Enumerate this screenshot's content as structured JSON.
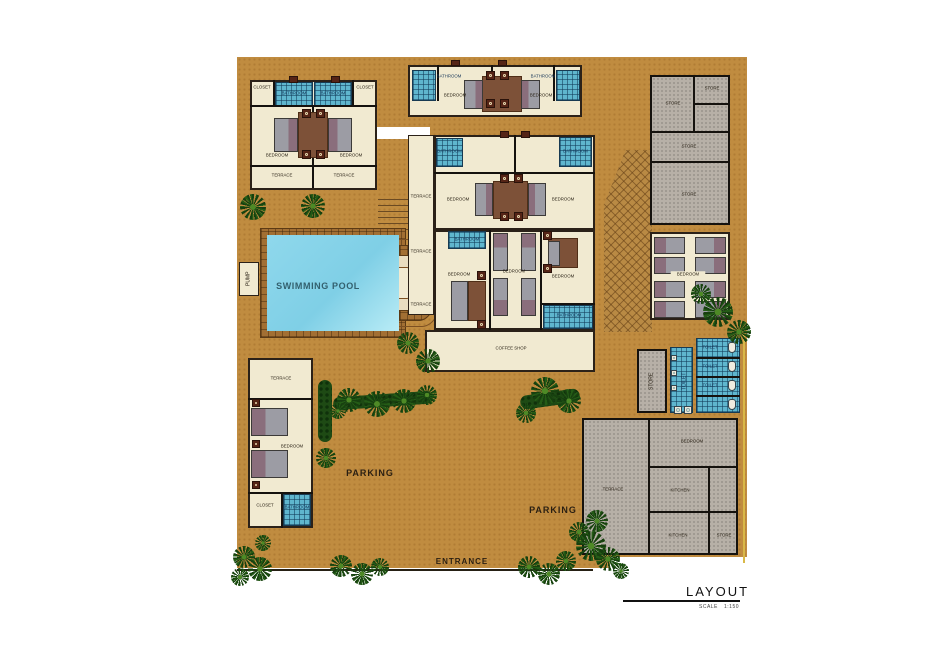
{
  "title_block": {
    "title": "LAYOUT",
    "scale_label": "SCALE",
    "scale_value": "1:150"
  },
  "site": {
    "pool": "SWIMMING POOL",
    "pump": "PUMP",
    "parking_left": "PARKING",
    "parking_right": "PARKING",
    "entrance": "ENTRANCE"
  },
  "villa_top_left": {
    "closet_l": "CLOSET",
    "closet_r": "CLOSET",
    "bath_l": "BATHROOM",
    "bath_r": "BATHROOM",
    "bed_l": "BEDROOM",
    "bed_r": "BEDROOM",
    "terr_l": "TERRACE",
    "terr_r": "TERRACE"
  },
  "villa_top_mid": {
    "bath_l": "BATHROOM",
    "bath_r": "BATHROOM",
    "bed_l": "BEDROOM",
    "bed_r": "BEDROOM"
  },
  "main_building": {
    "terr_1": "TERRACE",
    "terr_2": "TERRACE",
    "terr_3": "TERRACE",
    "bath_tl": "BATHROOM",
    "bath_tr": "BATHROOM",
    "bath_ml": "BATHROOM",
    "bath_br": "BATHROOM",
    "bed_ul": "BEDROOM",
    "bed_ur": "BEDROOM",
    "bed_ll": "BEDROOM",
    "bed_c": "BEDROOM",
    "bed_lr": "BEDROOM",
    "coffee": "COFFEE SHOP"
  },
  "stores_block": {
    "s1": "STORE",
    "s2": "STORE",
    "s3": "STORE",
    "s4": "STORE"
  },
  "dorm": {
    "bedroom": "BEDROOM"
  },
  "toilets": {
    "store": "STORE",
    "corridor": "TOILET",
    "t1": "TOILET",
    "t2": "TOILET",
    "t3": "TOILET"
  },
  "service": {
    "bedroom": "BEDROOM",
    "terrace": "TERRACE",
    "kitchen1": "KITCHEN",
    "kitchen2": "KITCHEN",
    "store": "STORE"
  },
  "villa_bottom_left": {
    "terrace": "TERRACE",
    "bedroom": "BEDROOM",
    "closet": "CLOSET",
    "bathroom": "BATHROOM"
  },
  "colors": {
    "sand": "#c08c40",
    "water": "#8fd8ec",
    "tile": "#5fb6ce",
    "deck": "#a26f33",
    "gray_room": "#b7b0a7",
    "cream_room": "#f1ead1",
    "tree": "#17400f"
  }
}
